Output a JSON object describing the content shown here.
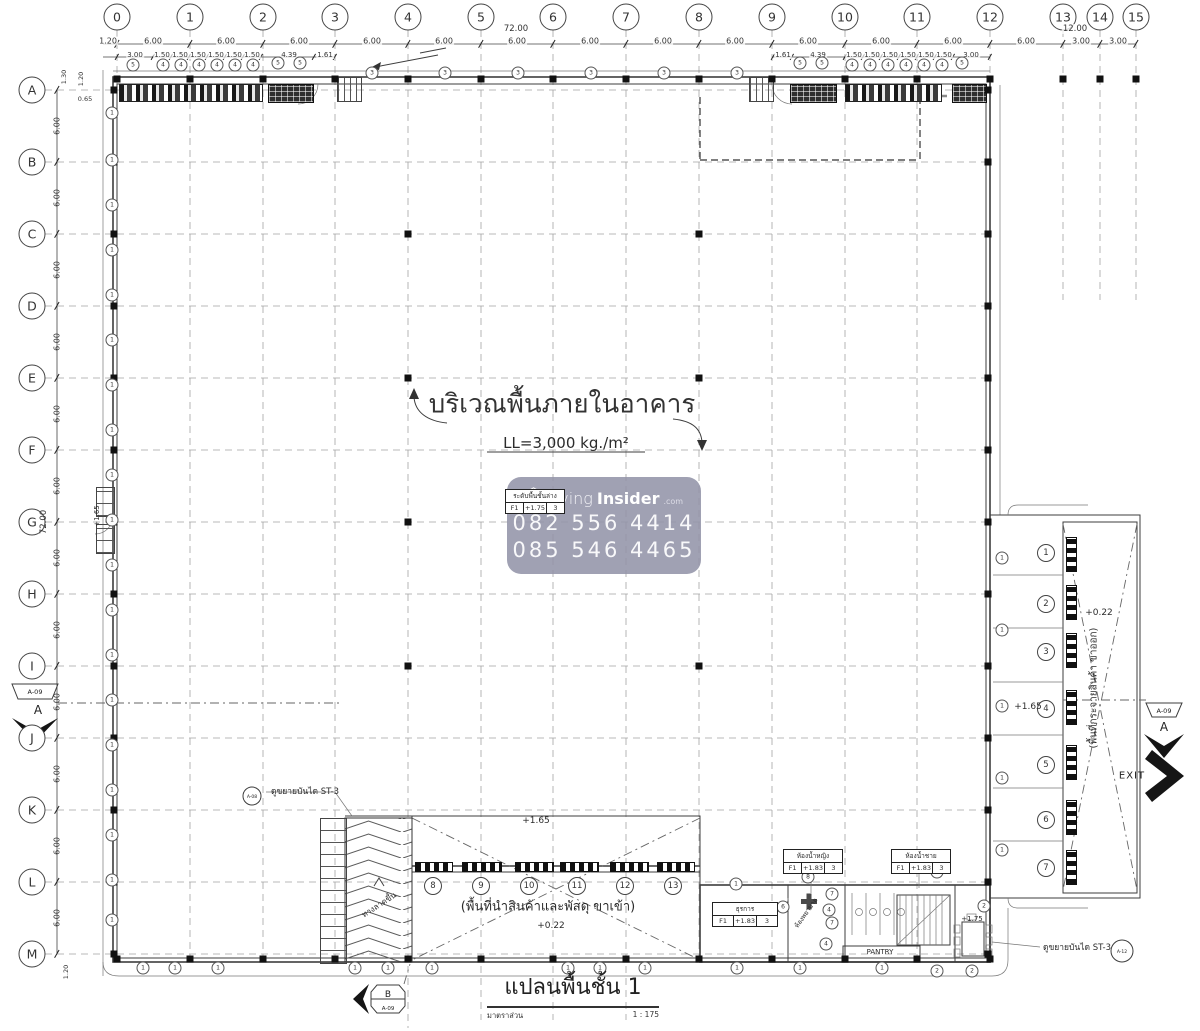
{
  "grid": {
    "columns": [
      {
        "label": "0",
        "x": 117
      },
      {
        "label": "1",
        "x": 190
      },
      {
        "label": "2",
        "x": 263
      },
      {
        "label": "3",
        "x": 335
      },
      {
        "label": "4",
        "x": 408
      },
      {
        "label": "5",
        "x": 481
      },
      {
        "label": "6",
        "x": 553
      },
      {
        "label": "7",
        "x": 626
      },
      {
        "label": "8",
        "x": 699
      },
      {
        "label": "9",
        "x": 772
      },
      {
        "label": "10",
        "x": 845
      },
      {
        "label": "11",
        "x": 917
      },
      {
        "label": "12",
        "x": 990
      },
      {
        "label": "13",
        "x": 1063
      },
      {
        "label": "14",
        "x": 1100
      },
      {
        "label": "15",
        "x": 1136
      }
    ],
    "rows": [
      {
        "label": "A",
        "y": 90
      },
      {
        "label": "B",
        "y": 162
      },
      {
        "label": "C",
        "y": 234
      },
      {
        "label": "D",
        "y": 306
      },
      {
        "label": "E",
        "y": 378
      },
      {
        "label": "F",
        "y": 450
      },
      {
        "label": "G",
        "y": 522
      },
      {
        "label": "H",
        "y": 594
      },
      {
        "label": "I",
        "y": 666
      },
      {
        "label": "J",
        "y": 738
      },
      {
        "label": "K",
        "y": 810
      },
      {
        "label": "L",
        "y": 882
      },
      {
        "label": "M",
        "y": 954
      }
    ],
    "interior_columns": [
      [
        408,
        234
      ],
      [
        699,
        234
      ],
      [
        408,
        378
      ],
      [
        699,
        378
      ],
      [
        408,
        522
      ],
      [
        408,
        666
      ],
      [
        699,
        666
      ]
    ]
  },
  "dimensions": {
    "overall_top": "72.00",
    "overall_top_right": "12.00",
    "overall_left": "72.00",
    "top_row1": [
      {
        "t": "1.20",
        "x": 108
      },
      {
        "t": "6.00",
        "x": 153
      },
      {
        "t": "6.00",
        "x": 226
      },
      {
        "t": "6.00",
        "x": 299
      },
      {
        "t": "6.00",
        "x": 372
      },
      {
        "t": "6.00",
        "x": 444
      },
      {
        "t": "6.00",
        "x": 517
      },
      {
        "t": "6.00",
        "x": 590
      },
      {
        "t": "6.00",
        "x": 663
      },
      {
        "t": "6.00",
        "x": 735
      },
      {
        "t": "6.00",
        "x": 808
      },
      {
        "t": "6.00",
        "x": 881
      },
      {
        "t": "6.00",
        "x": 953
      },
      {
        "t": "6.00",
        "x": 1026
      },
      {
        "t": "3.00",
        "x": 1081
      },
      {
        "t": "3.00",
        "x": 1118
      }
    ],
    "top_row2": [
      {
        "t": "3.00",
        "x": 135
      },
      {
        "t": "1.50",
        "x": 162
      },
      {
        "t": "1.50",
        "x": 180
      },
      {
        "t": "1.50",
        "x": 198
      },
      {
        "t": "1.50",
        "x": 216
      },
      {
        "t": "1.50",
        "x": 234
      },
      {
        "t": "1.50",
        "x": 252
      },
      {
        "t": "4.39",
        "x": 289
      },
      {
        "t": "1.61",
        "x": 325
      },
      {
        "t": "1.61",
        "x": 783
      },
      {
        "t": "4.39",
        "x": 818
      },
      {
        "t": "1.50",
        "x": 854
      },
      {
        "t": "1.50",
        "x": 872
      },
      {
        "t": "1.50",
        "x": 890
      },
      {
        "t": "1.50",
        "x": 908
      },
      {
        "t": "1.50",
        "x": 926
      },
      {
        "t": "1.50",
        "x": 944
      },
      {
        "t": "3.00",
        "x": 971
      }
    ],
    "left_col": [
      {
        "t": "6.00",
        "y": 126
      },
      {
        "t": "6.00",
        "y": 198
      },
      {
        "t": "6.00",
        "y": 270
      },
      {
        "t": "6.00",
        "y": 342
      },
      {
        "t": "6.00",
        "y": 414
      },
      {
        "t": "6.00",
        "y": 486
      },
      {
        "t": "6.00",
        "y": 558
      },
      {
        "t": "6.00",
        "y": 630
      },
      {
        "t": "6.00",
        "y": 702
      },
      {
        "t": "6.00",
        "y": 774
      },
      {
        "t": "6.00",
        "y": 846
      },
      {
        "t": "6.00",
        "y": 918
      }
    ],
    "small": [
      {
        "t": "1.30",
        "x": 64,
        "y": 77,
        "rot": 1
      },
      {
        "t": "1.20",
        "x": 81,
        "y": 79,
        "rot": 1
      },
      {
        "t": "0.65",
        "x": 85,
        "y": 99
      },
      {
        "t": "1.20",
        "x": 66,
        "y": 972,
        "rot": 1
      }
    ]
  },
  "annotations": [
    {
      "t": "บริเวณพื้นภายในอาคาร",
      "x": 562,
      "y": 404,
      "cls": "a-xl"
    },
    {
      "t": "LL=3,000 kg./m²",
      "x": 566,
      "y": 443,
      "cls": "a-md"
    },
    {
      "t": "(พื้นที่นำสินค้าและพัสดุ ขาเข้า)",
      "x": 548,
      "y": 906,
      "cls": "a-md2"
    },
    {
      "t": "+0.22",
      "x": 551,
      "y": 926,
      "cls": "a-lvl"
    },
    {
      "t": "+1.65",
      "x": 536,
      "y": 821,
      "cls": "a-lvl"
    },
    {
      "t": "+1.65",
      "x": 1028,
      "y": 707,
      "cls": "a-lvl"
    },
    {
      "t": "+0.22",
      "x": 1099,
      "y": 613,
      "cls": "a-lvl"
    },
    {
      "t": "(พื้นที่กระจายสินค้า ขาออก)",
      "x": 1094,
      "y": 688,
      "cls": "a-sm",
      "rot": -90
    },
    {
      "t": "+1.75",
      "x": 972,
      "y": 919,
      "cls": "a-xs"
    },
    {
      "t": "PANTRY",
      "x": 880,
      "y": 952,
      "cls": "a-xs"
    },
    {
      "t": "ทางลาดขึ้น",
      "x": 379,
      "y": 905,
      "cls": "a-xs2",
      "rot": -33
    },
    {
      "t": "ห้องพยาบาล",
      "x": 806,
      "y": 913,
      "cls": "a-xxs",
      "rot": -55
    },
    {
      "t": "ดูขยายบันได ST-3",
      "x": 305,
      "y": 791,
      "cls": "a-co"
    },
    {
      "t": "ดูขยายบันได ST-3",
      "x": 1077,
      "y": 947,
      "cls": "a-co"
    },
    {
      "t": "+1.65",
      "x": 97,
      "y": 516,
      "cls": "a-xs",
      "rot": -90
    },
    {
      "t": "EXIT",
      "x": 1132,
      "y": 776,
      "cls": "a-exit"
    }
  ],
  "boxes": [
    {
      "x": 505,
      "y": 489,
      "w": 58,
      "title": "ระดับพื้นชั้นล่าง",
      "cells": [
        "F1",
        "+1.75",
        "3"
      ],
      "top": true
    },
    {
      "x": 712,
      "y": 902,
      "w": 64,
      "title": "ธุรการ",
      "cells": [
        "F1",
        "+1.83",
        "3"
      ]
    },
    {
      "x": 783,
      "y": 849,
      "w": 58,
      "title": "ห้องน้ำหญิง",
      "cells": [
        "F1",
        "+1.83",
        "3"
      ]
    },
    {
      "x": 891,
      "y": 849,
      "w": 58,
      "title": "ห้องน้ำชาย",
      "cells": [
        "F1",
        "+1.83",
        "3"
      ]
    }
  ],
  "tags": [
    [
      133,
      65,
      "5"
    ],
    [
      163,
      65,
      "4"
    ],
    [
      181,
      65,
      "4"
    ],
    [
      199,
      65,
      "4"
    ],
    [
      217,
      65,
      "4"
    ],
    [
      235,
      65,
      "4"
    ],
    [
      253,
      65,
      "4"
    ],
    [
      278,
      63,
      "5"
    ],
    [
      300,
      63,
      "5"
    ],
    [
      372,
      73,
      "3"
    ],
    [
      445,
      73,
      "3"
    ],
    [
      518,
      73,
      "3"
    ],
    [
      591,
      73,
      "3"
    ],
    [
      664,
      73,
      "3"
    ],
    [
      737,
      73,
      "3"
    ],
    [
      800,
      63,
      "5"
    ],
    [
      822,
      63,
      "5"
    ],
    [
      852,
      65,
      "4"
    ],
    [
      870,
      65,
      "4"
    ],
    [
      888,
      65,
      "4"
    ],
    [
      906,
      65,
      "4"
    ],
    [
      924,
      65,
      "4"
    ],
    [
      942,
      65,
      "4"
    ],
    [
      962,
      63,
      "5"
    ],
    [
      736,
      884,
      "1"
    ],
    [
      808,
      877,
      "8"
    ],
    [
      783,
      907,
      "6"
    ],
    [
      832,
      894,
      "7"
    ],
    [
      829,
      910,
      "4"
    ],
    [
      832,
      923,
      "7"
    ],
    [
      826,
      944,
      "4"
    ],
    [
      937,
      872,
      "9"
    ],
    [
      984,
      906,
      "2"
    ],
    [
      737,
      968,
      "1"
    ],
    [
      800,
      968,
      "1"
    ],
    [
      882,
      968,
      "1"
    ],
    [
      937,
      971,
      "2"
    ],
    [
      972,
      971,
      "2"
    ]
  ],
  "dock_numbers_right": [
    [
      1046,
      553,
      "1"
    ],
    [
      1046,
      604,
      "2"
    ],
    [
      1046,
      652,
      "3"
    ],
    [
      1046,
      709,
      "4"
    ],
    [
      1046,
      765,
      "5"
    ],
    [
      1046,
      820,
      "6"
    ],
    [
      1046,
      868,
      "7"
    ]
  ],
  "dock_numbers_bottom": [
    [
      433,
      886,
      "8"
    ],
    [
      481,
      886,
      "9"
    ],
    [
      529,
      886,
      "10"
    ],
    [
      577,
      886,
      "11"
    ],
    [
      625,
      886,
      "12"
    ],
    [
      673,
      886,
      "13"
    ]
  ],
  "geometry": {
    "col_line_ends": {
      "default": 966,
      "4": 1028,
      "5": 1020,
      "6": 1020,
      "7": 1020,
      "13": 300,
      "14": 300,
      "15": 300
    },
    "row2_ticks": [
      117,
      153,
      171,
      189,
      207,
      225,
      243,
      261,
      314,
      335,
      773,
      792,
      845,
      863,
      881,
      899,
      917,
      935,
      953,
      990
    ],
    "strips_bottom": [
      [
        415,
        36
      ],
      [
        462,
        38
      ],
      [
        515,
        37
      ],
      [
        560,
        37
      ],
      [
        610,
        37
      ],
      [
        657,
        36
      ]
    ],
    "strips_right": [
      [
        537,
        33
      ],
      [
        585,
        33
      ],
      [
        633,
        33
      ],
      [
        690,
        33
      ],
      [
        745,
        33
      ],
      [
        800,
        33
      ],
      [
        850,
        33
      ]
    ],
    "left_wall_tag_ys": [
      113,
      160,
      205,
      250,
      295,
      340,
      385,
      430,
      475,
      520,
      565,
      610,
      655,
      700,
      745,
      790,
      835,
      880,
      920
    ],
    "bottom_wall_tag_xs": [
      143,
      175,
      218,
      355,
      388,
      432,
      568,
      600,
      645
    ],
    "right_wall_tag_ys": [
      558,
      630,
      706,
      778,
      850
    ]
  },
  "watermark": {
    "brand_light": "Living",
    "brand_bold": "Insider",
    "brand_suffix": ".com",
    "phone1": "082 556 4414",
    "phone2": "085 546 4465",
    "bg": "#9394a9"
  },
  "titleblock": {
    "title": "แปลนพื้นชั้น 1",
    "scale_label": "มาตราส่วน",
    "scale_value": "1 : 175"
  },
  "markers": {
    "sheet": "A-09",
    "a_label": "A",
    "b_label": "B",
    "callout_circle_left": "A-08",
    "callout_circle_right": "A-12"
  }
}
